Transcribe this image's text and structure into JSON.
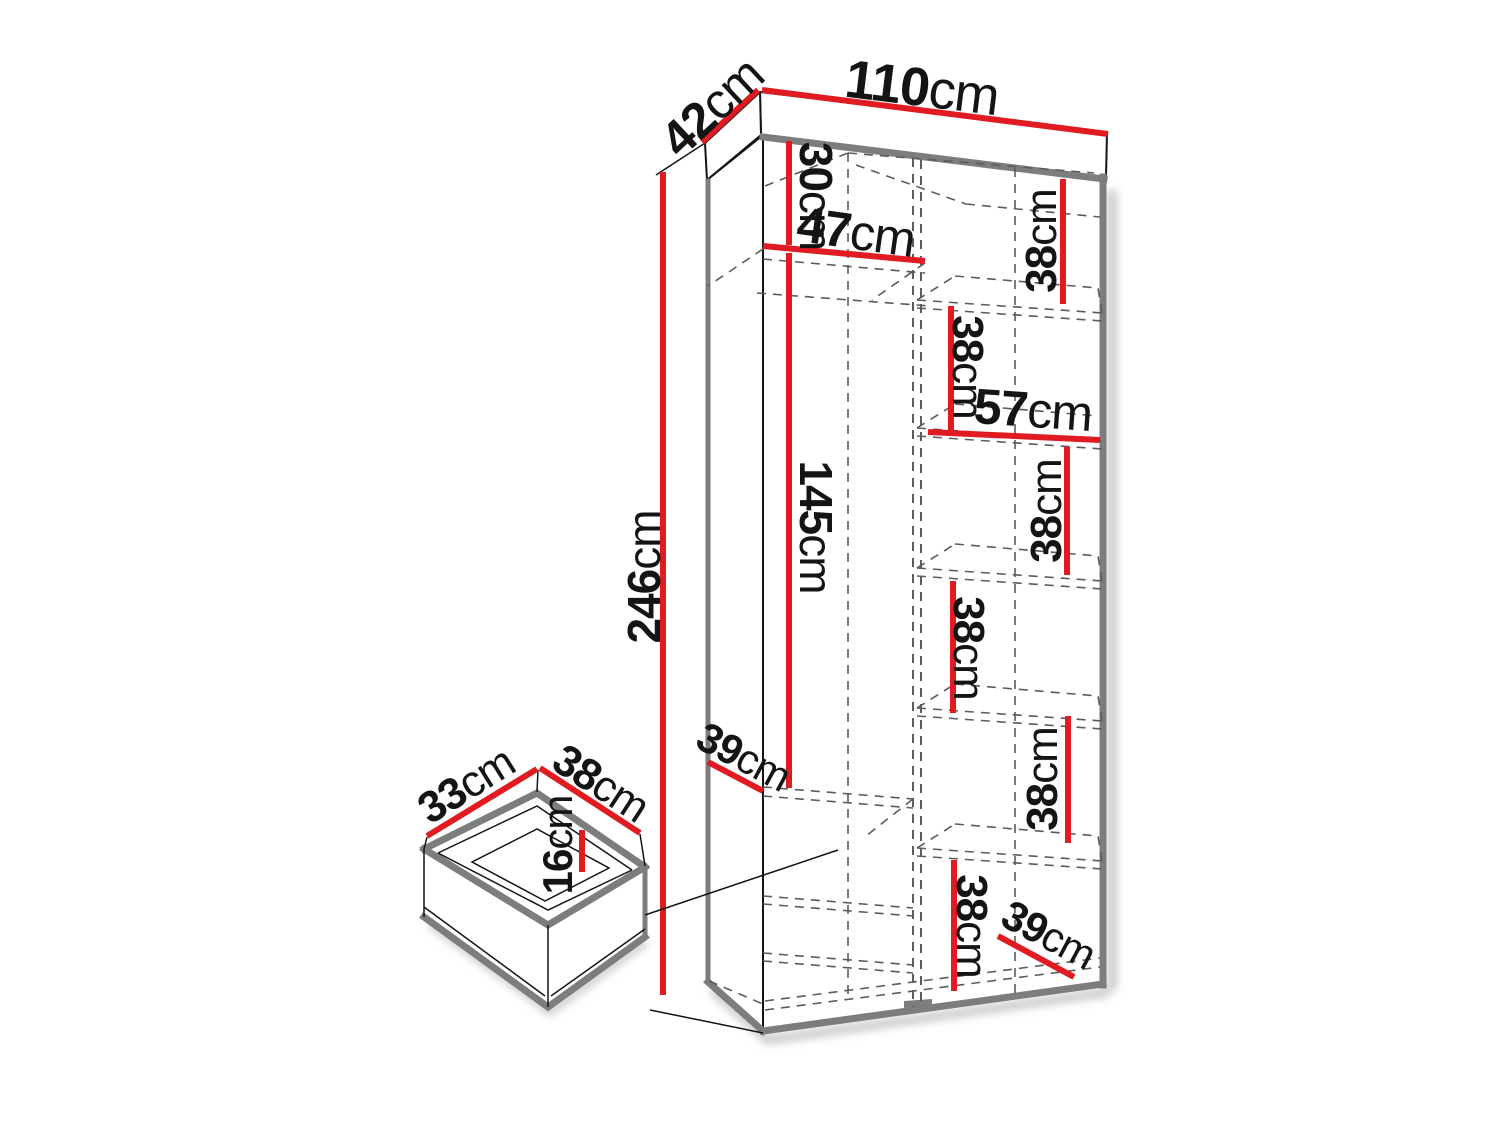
{
  "colors": {
    "red": "#e11b22",
    "ink": "#141414",
    "gray": "#7d7d7d",
    "dash": "#5c5c5c",
    "shadow": "#b5b5b5",
    "bg": "#ffffff"
  },
  "diagram_type": "furniture-dimension-drawing",
  "wardrobe": {
    "width": {
      "value": "110",
      "unit": "cm"
    },
    "depth": {
      "value": "42",
      "unit": "cm"
    },
    "height": {
      "value": "246",
      "unit": "cm"
    },
    "top_compartment_height": {
      "value": "30",
      "unit": "cm"
    },
    "left_section_width": {
      "value": "47",
      "unit": "cm"
    },
    "hanging_space_height": {
      "value": "145",
      "unit": "cm"
    },
    "right_shelf_width": {
      "value": "57",
      "unit": "cm"
    },
    "bottom_shelf_depth_left": {
      "value": "39",
      "unit": "cm"
    },
    "bottom_shelf_depth_right": {
      "value": "39",
      "unit": "cm"
    },
    "shelf_gaps": [
      {
        "value": "38",
        "unit": "cm"
      },
      {
        "value": "38",
        "unit": "cm"
      },
      {
        "value": "38",
        "unit": "cm"
      },
      {
        "value": "38",
        "unit": "cm"
      },
      {
        "value": "38",
        "unit": "cm"
      },
      {
        "value": "38",
        "unit": "cm"
      }
    ]
  },
  "drawer": {
    "depth": {
      "value": "33",
      "unit": "cm"
    },
    "width": {
      "value": "38",
      "unit": "cm"
    },
    "height": {
      "value": "16",
      "unit": "cm"
    }
  }
}
